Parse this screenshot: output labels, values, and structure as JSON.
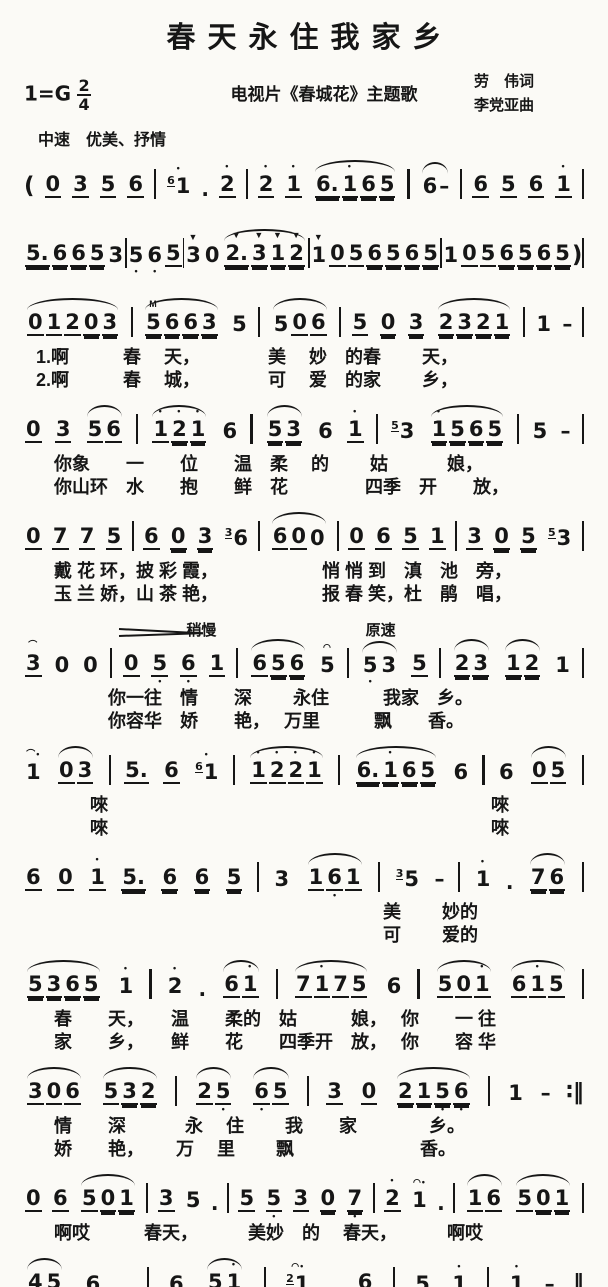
{
  "header": {
    "title": "春天永住我家乡",
    "key_label": "1=G",
    "time_top": "2",
    "time_bottom": "4",
    "subtitle": "电视片《春城花》主题歌",
    "lyricist": "劳　伟词",
    "composer": "李党亚曲",
    "tempo": "中速　优美、抒情"
  },
  "systems": [
    {
      "gap": "big",
      "notes": "( 0_ 3_ 5_ 6_ | {6}1' . 2'_ | 2'_ 1'_ [ 6.= 1'= 6= 5= ] | [ 6 - ] | 6_ 5_ 6_ 1'_ |",
      "lyrics": []
    },
    {
      "gap": "big",
      "notes": "5.= 6= 6= 5= 3 | 5, 6, 5_ | 3v 0 [ 2.v= 3v= 1v= 2v= ] | 1v 0_ 5_ 6= 5= 6= 5= | 1 0_ 5_ 6= 5= 6= 5= ) |",
      "lyrics": []
    },
    {
      "notes": "[ 0_ 1_ 2_ 0= 3= ] | [ 5m= 6= 6= 3= ] 5 | [ 5 0_ 6_ ] | 5_ 0= 3= [ 2= 3= 2= 1= ] | 1 - |",
      "lyrics": [
        "1.啊　　　春　 天，　　　　 美　 妙　的春　　 天，",
        "2.啊　　　春　 城，　　　　 可　 爱　的家　　 乡，"
      ]
    },
    {
      "notes": "0_ 3_ [ 5_ 6_ ] | [ 1'_ 2'= 1'= ] 6 | [ 5= 3= ] 6 1'_ | {5}3 [ 1'= 5= 6= 5= ] | 5 - |",
      "lyrics": [
        "　你象　　一　　位　　温　柔　 的　　 姑　　　 娘，",
        "　你山环　水　　抱　　鲜　花　　　　 四季　开　　放，"
      ]
    },
    {
      "notes": "0_ 7_ 7_ 5_ | 6_ 0= 3= {3}6 | [ 6_ 0_ 0 ] | 0_ 6_ 5_ 1_ | 3_ 0= 5= {5}3 |",
      "lyrics": [
        "　戴 花 环，披 彩 霞，　　　　　　 悄 悄 到　滇　池　旁，",
        "　玉 兰 娇，山 茶 艳，　　　　　　 报 春 笑，杜　鹃　唱，"
      ]
    },
    {
      "marks": [
        {
          "text": "稍慢",
          "left": "29%"
        },
        {
          "text": "原速",
          "left": "61%"
        }
      ],
      "hairpin": {
        "left": "17%",
        "width": "84px"
      },
      "notes": "3~_ 0 0 | 0_ 5,_ 6,_ 1_ | [ 6_ 5= 6= ] 5^ | [ 5, 3 ] 5_ | [ 2= 3= ] [ 1= 2= ] 1 |",
      "lyrics": [
        "　　　　你一往　情　　深　　 永住　　　我家　乡。",
        "　　　　你容华　娇　　艳，　 万里　　　飘　　香。"
      ]
    },
    {
      "notes": "1'~ [ 0_ 3_ ] | 5._ 6_ {6}1' | [ 1'_ 2'_ 2'_ 1'_ ] | [ 6.= 1'= 6= 5= ] 6 | 6 [ 0_ 5_ ] |",
      "lyrics": [
        "　　　唻　　　　　　　　　　　　　　　　　　　　　 唻",
        "　　　唻　　　　　　　　　　　　　　　　　　　　　 唻"
      ]
    },
    {
      "notes": "6_ 0_ 1'_ 5.= 6= 6= 5= | 3 [ 1_ 6,_ 1_ ] | {3}5 - | 1' . [ 7= 6= ] |",
      "lyrics": [
        "　　　　　　　　　　　　　　　　　　　 美　　 妙的",
        "　　　　　　　　　　　　　　　　　　　 可　　 爱的"
      ]
    },
    {
      "notes": "[ 5= 3= 6= 5= ] 1' | 2' . [ 6_ 1'_ ] | [ 7_ 1'_ 7_ 5_ ] 6 | [ 5_ 0_ 1'_ ] [ 6_ 1'_ 5_ ] |",
      "lyrics": [
        "　春　　天，　　温　　柔的　姑　　　娘，　 你　　一 往",
        "　家　　乡，　　鲜　　花　　四季开　放，　 你　　容 华"
      ]
    },
    {
      "notes": "[ 3_ 0_ 6_ ] [ 5_ 3= 2= ] | [ 2_ 5,_ ] [ 6,_ 5_ ] | 3_ 0_ [ 2= 1= 5,= 6,= ] | 1 - :|",
      "lyrics": [
        "　情　　深　　　 永　 住　　 我　　家　　　　乡。",
        "　娇　　艳，　　 万　 里　　 飘　　　　　　　香。"
      ]
    },
    {
      "notes": "0_ 6_ [ 5_ 0= 1= ] | 3_ 5 . | 5_ 5,_ 3_ 0= 7,= | 2'_ 1'^ . | [ 1_ 6_ ] [ 5_ 0= 1= ] |",
      "lyrics": [
        "　啊哎　　　春天，　　　 美妙　的　 春天，　　　 啊哎"
      ]
    },
    {
      "notes": "[ 4= 5= ] 6 . | 6 [ 5_ 1'_ ] | {2}1'^ . 6_ | 5 1' | 1' - ‖",
      "lyrics": [
        "　春 城，　　　　　 可　　 爱　　的　　家　 乡。"
      ]
    }
  ]
}
